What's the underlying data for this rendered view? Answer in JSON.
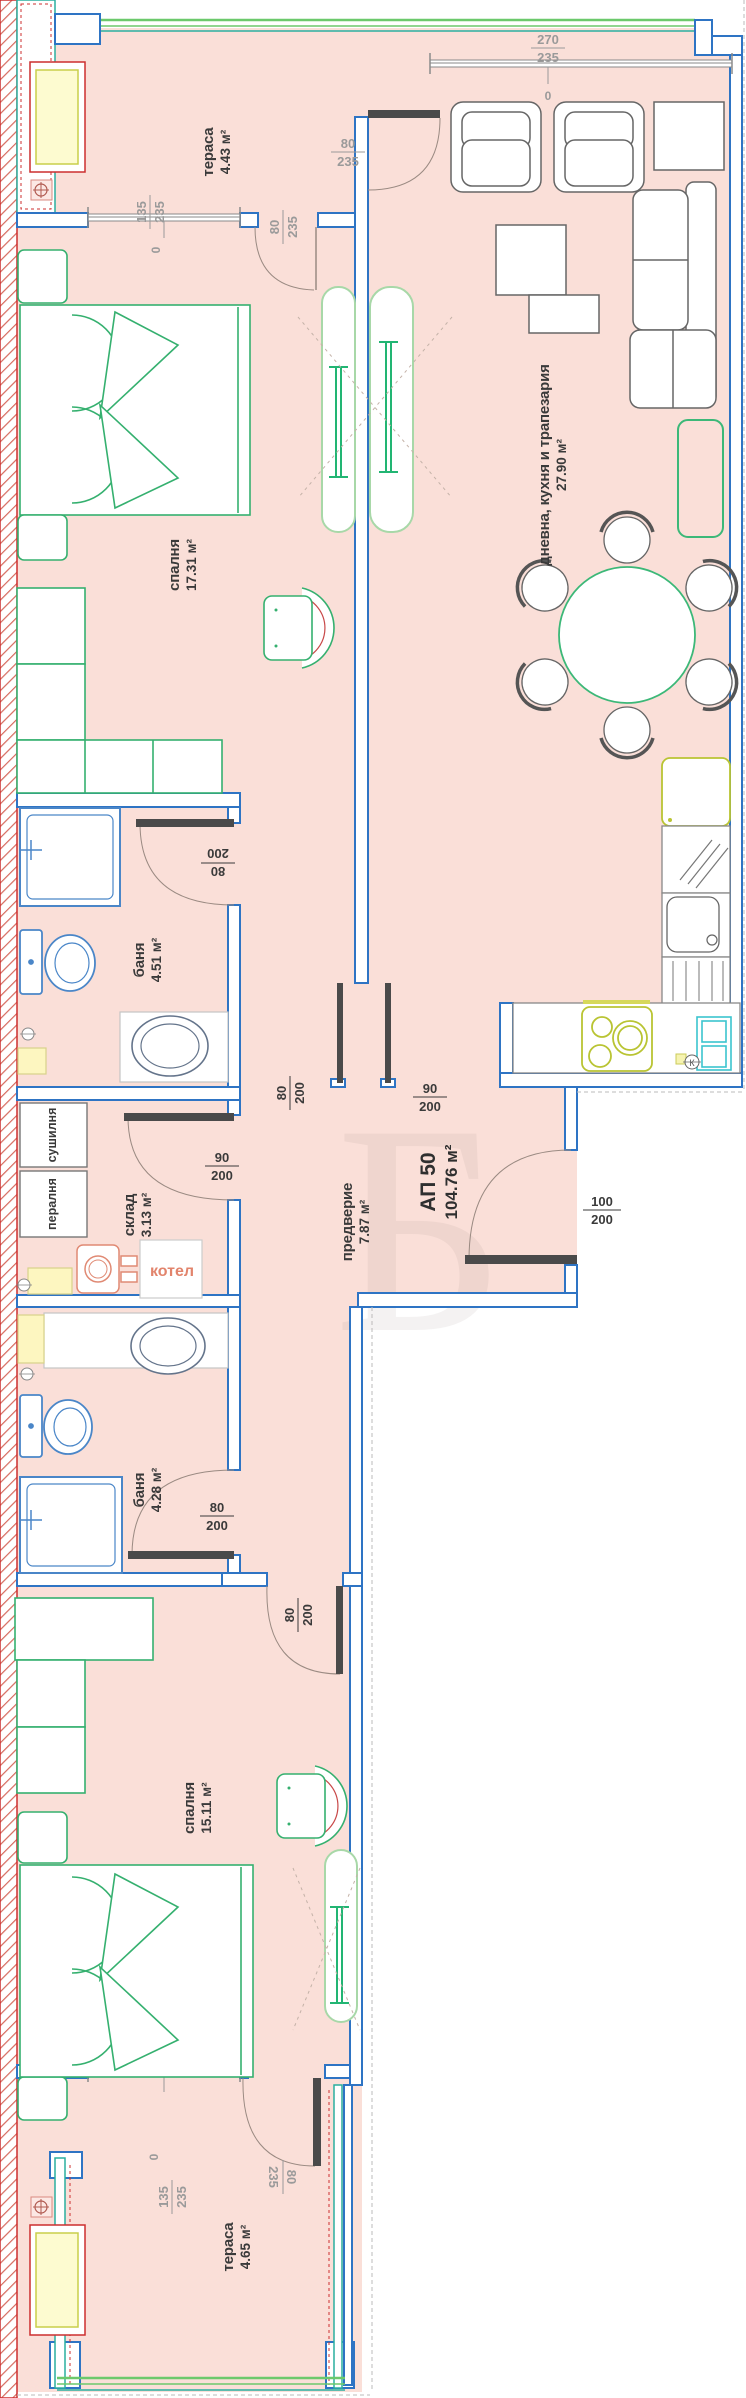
{
  "apartment": {
    "id": "АП 50",
    "area": "104.76 м²"
  },
  "rooms": {
    "terrace_top": {
      "name": "тераса",
      "area": "4.43 м²"
    },
    "bedroom_top": {
      "name": "спалня",
      "area": "17.31 м²"
    },
    "living": {
      "name": "дневна, кухня и трапезария",
      "area": "27.90 м²"
    },
    "bath_top": {
      "name": "баня",
      "area": "4.51 м²"
    },
    "storage": {
      "name": "склад",
      "area": "3.13 м²"
    },
    "hall": {
      "name": "предверие",
      "area": "7.87 м²"
    },
    "bath_bottom": {
      "name": "баня",
      "area": "4.28 м²"
    },
    "bedroom_bottom": {
      "name": "спалня",
      "area": "15.11 м²"
    },
    "terrace_bottom": {
      "name": "тераса",
      "area": "4.65 м²"
    }
  },
  "appliances": {
    "washer": "пералня",
    "dryer": "сушилня",
    "boiler": "котел"
  },
  "dims": {
    "zero": "0",
    "d135_235": {
      "w": "135",
      "h": "235"
    },
    "d80_235": {
      "w": "80",
      "h": "235"
    },
    "d270_235": {
      "w": "270",
      "h": "235"
    },
    "d80_200": {
      "w": "80",
      "h": "200"
    },
    "d90_200": {
      "w": "90",
      "h": "200"
    },
    "d100_200": {
      "w": "100",
      "h": "200"
    }
  },
  "symbols": {
    "gas_valve": "К"
  },
  "watermark": {
    "letter": "Б"
  },
  "colors": {
    "wall_blue": "#2e74c4",
    "floor_pink": "#fadfd8",
    "furniture_green": "#35b06f",
    "teal": "#2aaf9f",
    "red": "#cc2f2f",
    "kitchen_yellow": "#b9c433",
    "salmon": "#e2846c",
    "dim_gray": "#9a9a9a",
    "text_dark": "#3a3a3a"
  }
}
